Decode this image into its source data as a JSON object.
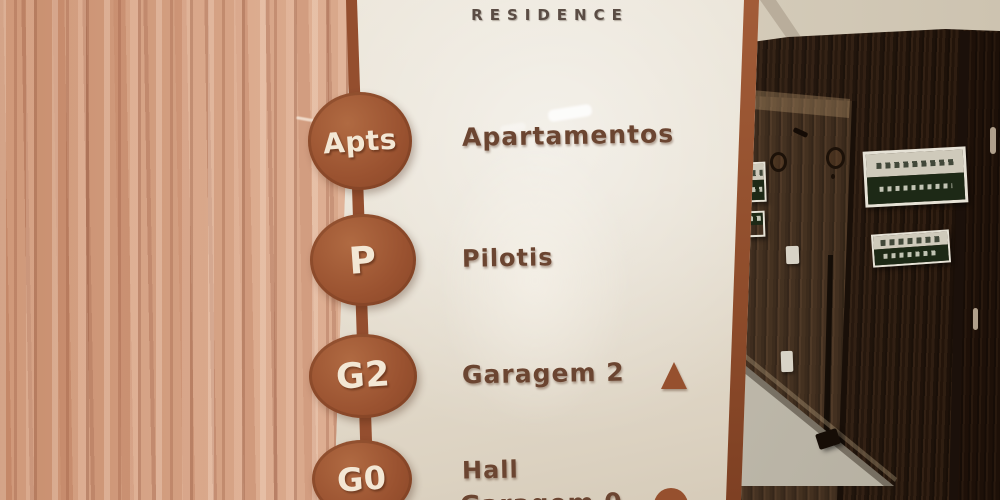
{
  "sign": {
    "header": "RESIDENCE",
    "rows": [
      {
        "badge": "Apts",
        "label": "Apartamentos",
        "icon": ""
      },
      {
        "badge": "P",
        "label": "Pilotis",
        "icon": ""
      },
      {
        "badge": "G2",
        "label": "Garagem 2",
        "icon": "up-triangle"
      },
      {
        "badge": "G0",
        "label": "Hall",
        "label_secondary": "Garagem 0",
        "icon": "round-partial"
      }
    ],
    "colors": {
      "badge_terracotta": "#9a5230",
      "frame_terracotta": "#96522f",
      "panel_cream": "#e7e0d1",
      "label_brown": "#6b4531",
      "header_gray_brown": "#5a4c44",
      "wood_wall": "#d0a286",
      "hallway_wood_dark": "#38281c",
      "floor_gray": "#c5c0b2"
    }
  }
}
